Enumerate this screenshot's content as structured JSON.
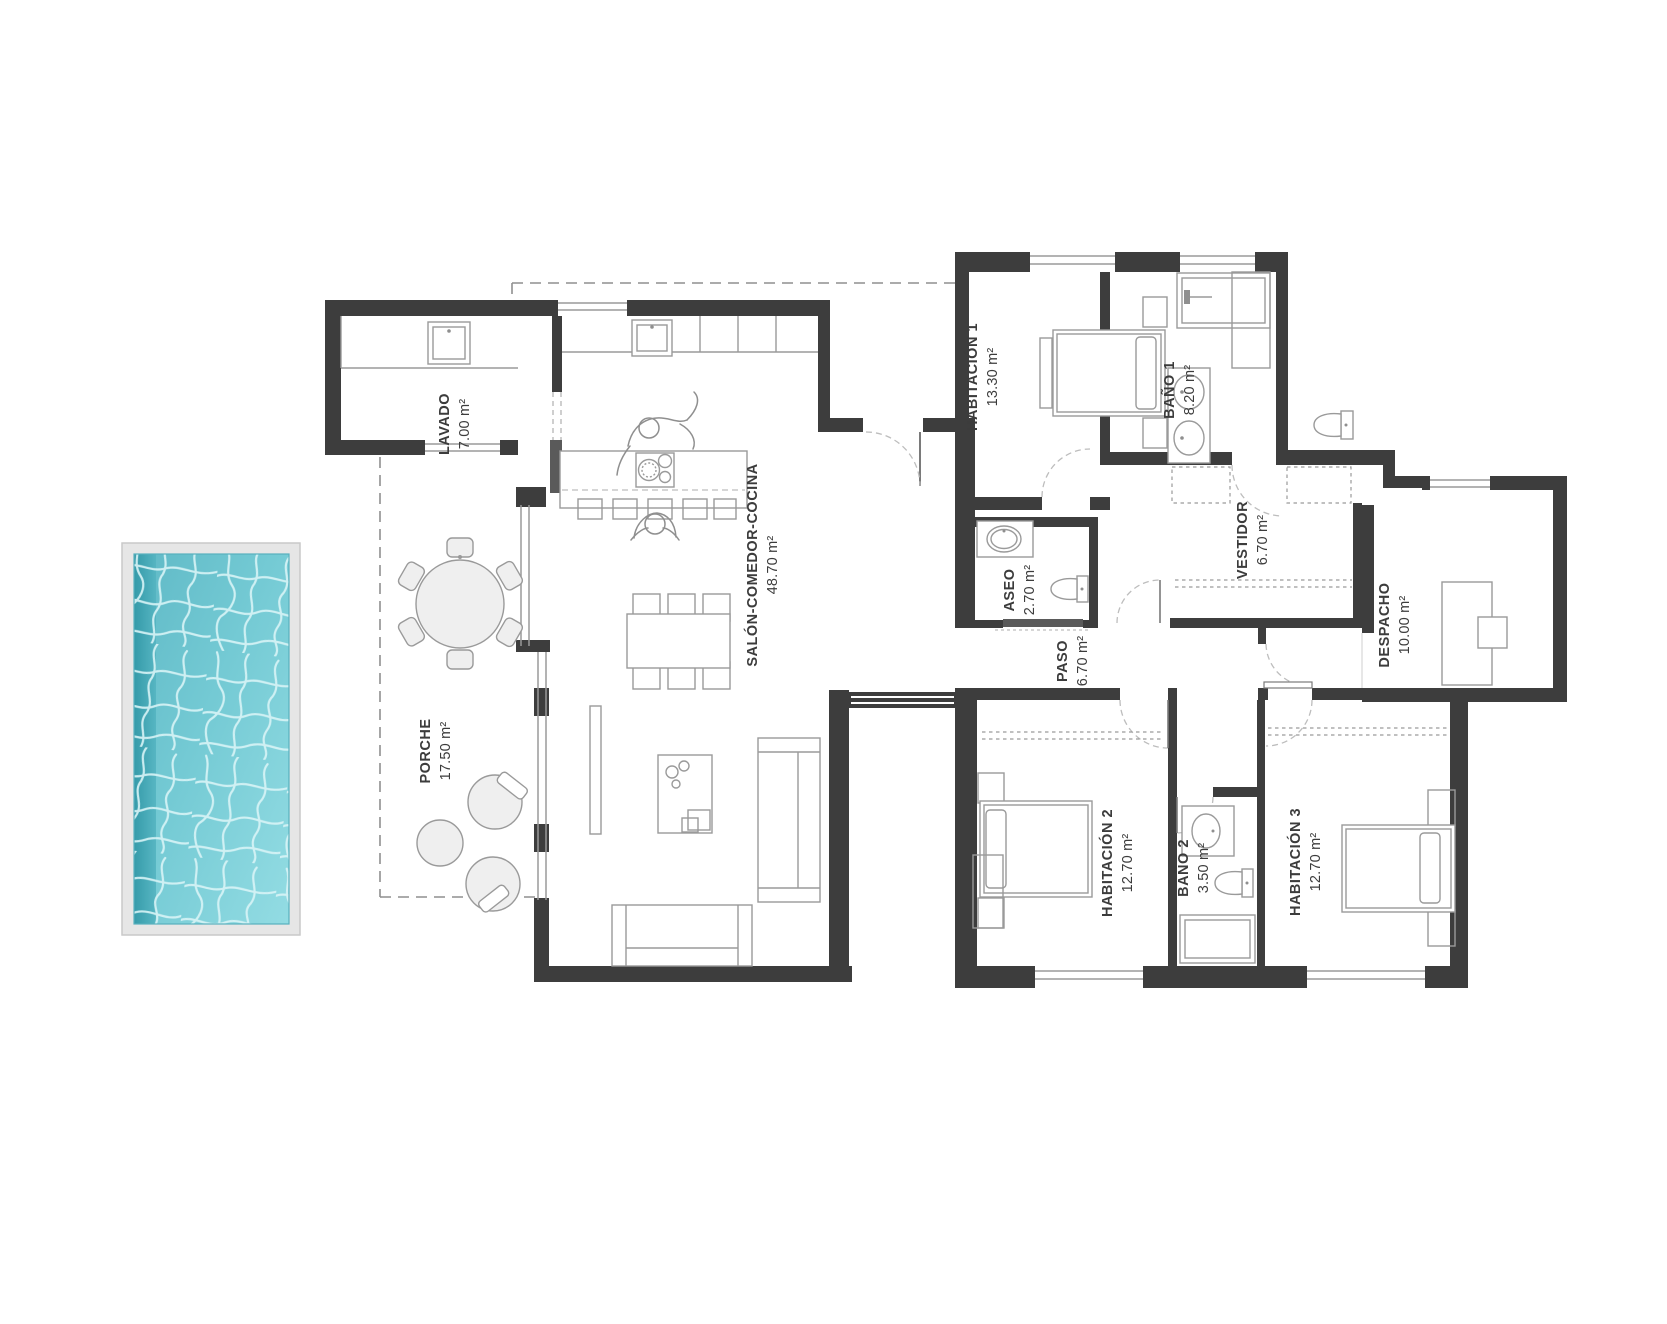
{
  "plan": {
    "rooms": [
      {
        "id": "lavado",
        "name": "LAVADO",
        "area": "7.00 m²"
      },
      {
        "id": "salon",
        "name": "SALÓN-COMEDOR-COCINA",
        "area": "48.70 m²"
      },
      {
        "id": "porche",
        "name": "PORCHE",
        "area": "17.50 m²"
      },
      {
        "id": "habitacion1",
        "name": "HABITACIÓN  1",
        "area": "13.30 m²"
      },
      {
        "id": "bano1",
        "name": "BAÑO 1",
        "area": "8.20 m²"
      },
      {
        "id": "aseo",
        "name": "ASEO",
        "area": "2.70 m²"
      },
      {
        "id": "vestidor",
        "name": "VESTIDOR",
        "area": "6.70 m²"
      },
      {
        "id": "paso",
        "name": "PASO",
        "area": "6.70 m²"
      },
      {
        "id": "despacho",
        "name": "DESPACHO",
        "area": "10.00 m²"
      },
      {
        "id": "habitacion2",
        "name": "HABITACIÓN  2",
        "area": "12.70 m²"
      },
      {
        "id": "bano2",
        "name": "BAÑO 2",
        "area": "3.50 m²"
      },
      {
        "id": "habitacion3",
        "name": "HABITACIÓN  3",
        "area": "12.70 m²"
      }
    ],
    "colors": {
      "wall": "#3d3d3d",
      "label_text": "#3c3c3c",
      "furniture_line": "#9a9a9a",
      "door_arc": "#bdbdbd",
      "pool_frame": "#e6e6e6",
      "pool_water_dark": "#2f96a5",
      "pool_water_mid": "#64c2cd",
      "pool_water_light": "#93dce3",
      "pool_caustic": "#d9f4f7"
    }
  }
}
